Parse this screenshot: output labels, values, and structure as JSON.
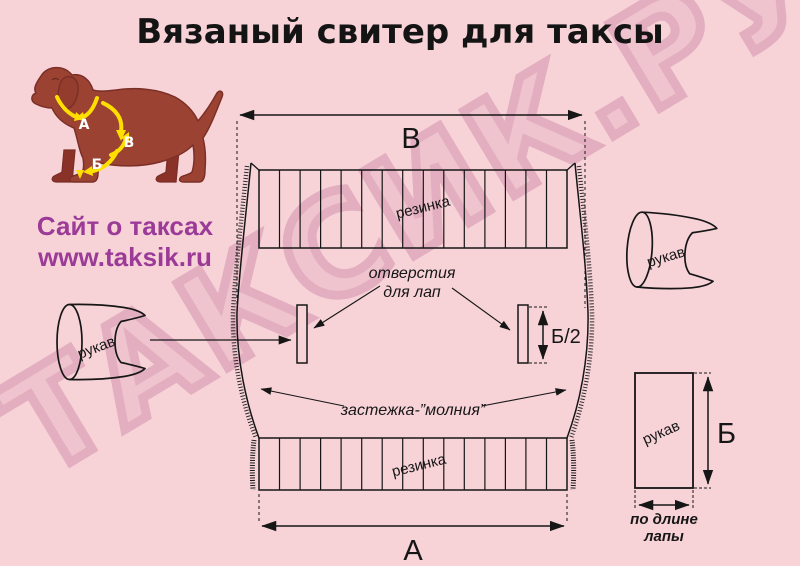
{
  "title": "Вязаный свитер для таксы",
  "watermark": "ТАКСИК.РУ",
  "site": {
    "line1": "Сайт о таксах",
    "line2": "www.taksik.ru"
  },
  "dog": {
    "label_a": "А",
    "label_v": "В",
    "label_b": "Б"
  },
  "pattern": {
    "dim_top": "В",
    "dim_bottom": "А",
    "ribbing_top": "резинка",
    "ribbing_bottom": "резинка",
    "openings_line1": "отверстия",
    "openings_line2": "для лап",
    "opening_height": "Б/2",
    "zipper": "застежка-”молния”"
  },
  "sleeves": {
    "left_label": "рукав",
    "top_right_label": "рукав",
    "flat_label": "рукав",
    "flat_height": "Б",
    "flat_width_line1": "по длине",
    "flat_width_line2": "лапы"
  },
  "colors": {
    "background": "#f7d3d8",
    "watermark_pink": "#e2aec0",
    "line": "#161616",
    "dog_body": "#9c4233",
    "dog_outline": "#7b2f27",
    "arrow_yellow": "#ffdf00",
    "site_purple": "#9b3a97"
  }
}
